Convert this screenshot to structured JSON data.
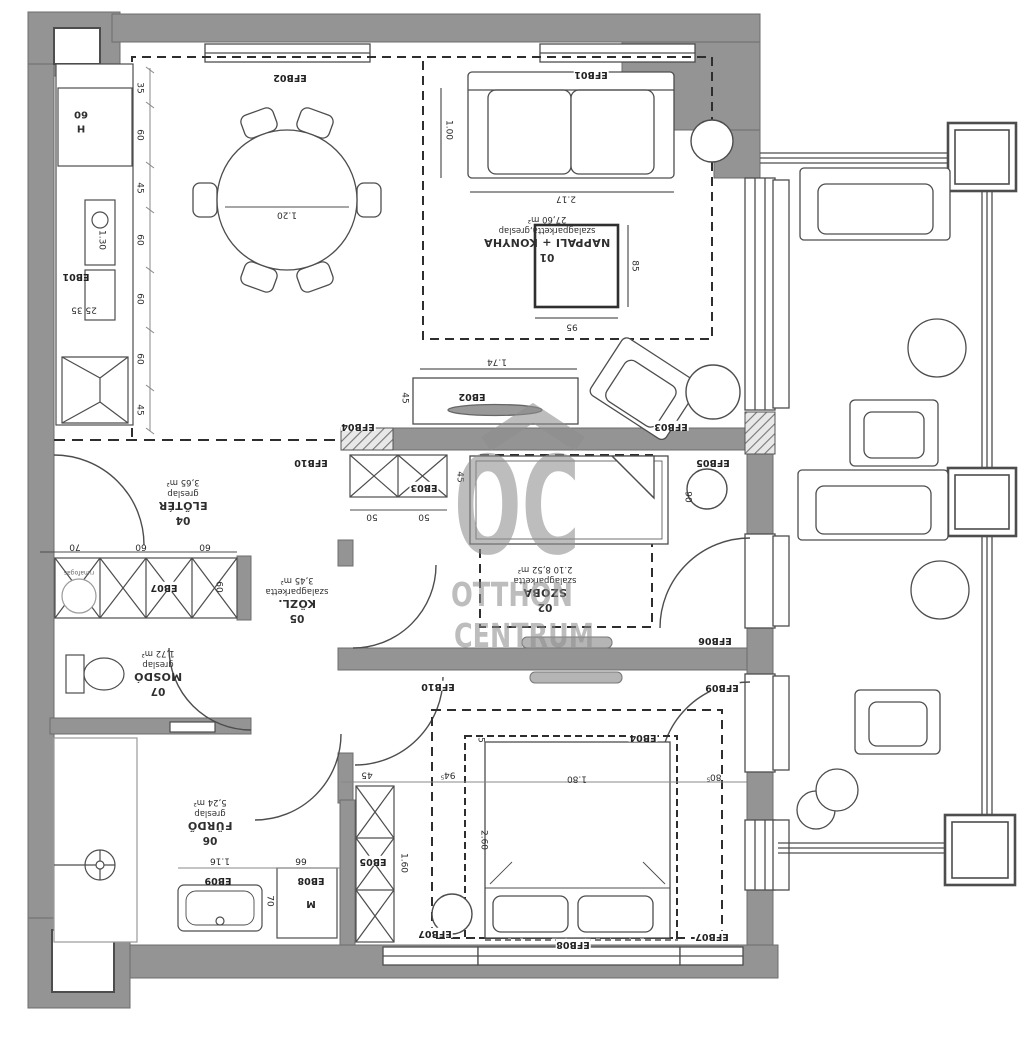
{
  "watermark": {
    "logo": "OC",
    "line1": "OTTHON",
    "line2": "CENTRUM"
  },
  "rooms": {
    "r01": {
      "num": "01",
      "name": "NAPPALI + KONYHA",
      "floor": "szalagparketta,greslap",
      "area": "27,60 m²"
    },
    "r02": {
      "num": "02",
      "name": "SZOBA",
      "floor": "szalagparketta",
      "area": "2.10  8,52 m²"
    },
    "r04": {
      "num": "04",
      "name": "ELŐTÉR",
      "floor": "greslap",
      "area": "3,65 m²"
    },
    "r05": {
      "num": "05",
      "name": "KÖZL.",
      "floor": "szalagparketta",
      "area": "3,45 m²"
    },
    "r06": {
      "num": "06",
      "name": "FÜRDŐ",
      "floor": "greslap",
      "area": "5,24 m²"
    },
    "r07": {
      "num": "07",
      "name": "MOSDÓ",
      "floor": "greslap",
      "area": "1,72 m²"
    }
  },
  "fixtures": {
    "eb01": "EB01",
    "eb02": "EB02",
    "eb03": "EB03",
    "eb04": "EB04",
    "eb05": "EB05",
    "eb07": "EB07",
    "eb08": "EB08",
    "eb09": "EB09",
    "washer": "M",
    "fridge": "H",
    "coatrack": "ruhafogas"
  },
  "openings": {
    "efb01": "EFB01",
    "efb02": "EFB02",
    "efb03": "EFB03",
    "efb04": "EFB04",
    "efb05": "EFB05",
    "efb06": "EFB06",
    "efb07": "EFB07",
    "efb08": "EFB08",
    "efb09": "EFB09",
    "efb10": "EFB10"
  },
  "dims": {
    "d35": "35",
    "d60": "60",
    "d45": "45",
    "d130": "1.30",
    "d2535": "25  35",
    "d120": "1.20",
    "d217": "2.17",
    "d100": "1.00",
    "d85": "85",
    "d95": "95",
    "d174": "1.74",
    "d50": "50",
    "d70": "70",
    "d90": "90",
    "d945": "94⁵",
    "d180": "1.80",
    "d5": "5",
    "d805": "80⁵",
    "d260": "2.60",
    "d160": "1.60",
    "d116": "1.16",
    "d66": "66"
  },
  "colors": {
    "wall": "#949494",
    "line": "#4d4d4d",
    "watermark": "#8e8e8e"
  }
}
